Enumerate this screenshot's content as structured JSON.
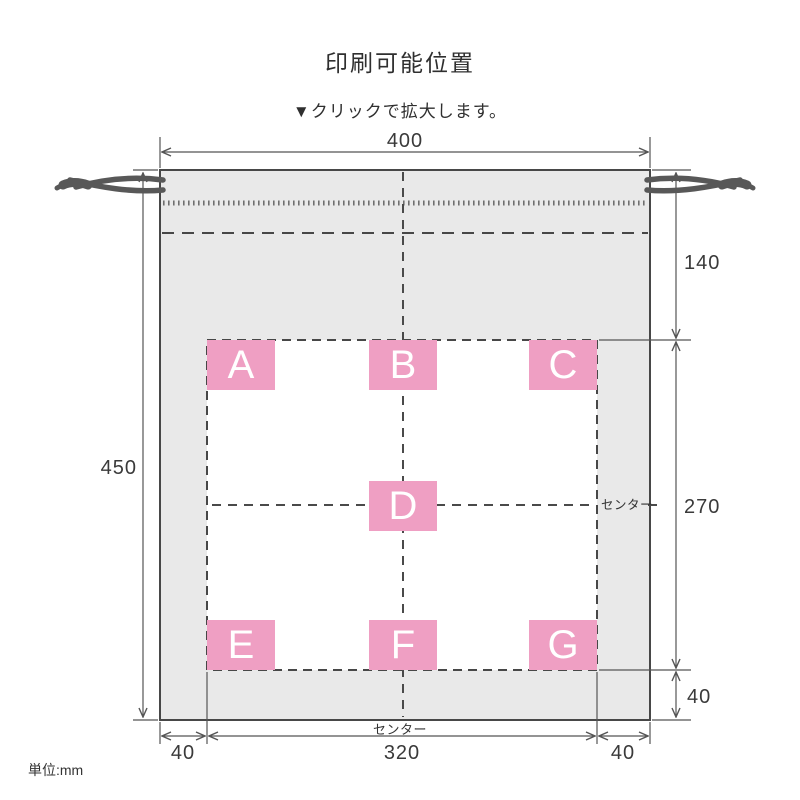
{
  "page": {
    "title": "印刷可能位置",
    "subtitle": "▼クリックで拡大します。",
    "unit_note": "単位:mm"
  },
  "diagram": {
    "dimensions": {
      "top_width": "400",
      "left_height": "450",
      "right_top": "140",
      "right_middle": "270",
      "right_bottom": "40",
      "bottom_left": "40",
      "bottom_center": "320",
      "bottom_right": "40"
    },
    "center_label_right": "センター",
    "center_label_bottom": "センター",
    "print_positions": [
      "A",
      "B",
      "C",
      "D",
      "E",
      "F",
      "G"
    ]
  },
  "colors": {
    "pink": "#ef9fc3",
    "bag_fill": "#e9e9e9",
    "outline": "#474747",
    "dim_line": "#555555",
    "text": "#333333"
  }
}
